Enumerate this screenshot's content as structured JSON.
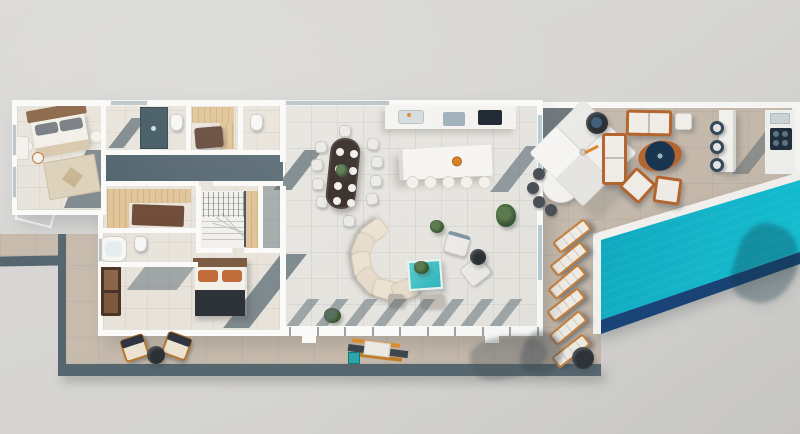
{
  "scene": {
    "type": "3d-floor-plan-render",
    "description": "Top-down 3D rendered villa floor plan with bedrooms, bathrooms, open-plan kitchen-dining-living space, wrap-around stone terrace, outdoor lounge with square parasol, outdoor kitchen and bar, six sun loungers and a turquoise swimming pool"
  },
  "palette": {
    "background": "#d8d7d5",
    "wall": "#fafaf8",
    "floor_left_wing": "#e8e3da",
    "floor_open_plan": "#e6e4df",
    "terrace": "#c7bbad",
    "slate": "#55666f",
    "pool_water": "#10b9cf",
    "pool_water_deep": "#0aa6be",
    "pool_wall": "#123e72",
    "wood_light": "#e0c396",
    "wood_mid": "#b5652f",
    "wood_dark": "#6b4a33",
    "orange_accent": "#d08035",
    "cream_cushion": "#ece2d1",
    "white_furniture": "#f3f1ec",
    "dark_table": "#2b3035",
    "teal_table": "#3bbfc4",
    "plant_green": "#3c5a36",
    "bed_blanket": "#2c3237",
    "glass_blue": "#b7ccd6",
    "lounger_frame": "#c97e35",
    "lounger_cushion": "#f2efe8"
  },
  "furniture": {
    "sun_loungers": {
      "count": 6,
      "w": 40,
      "h": 14,
      "items": [
        {
          "x": 552,
          "y": 229,
          "r": -38
        },
        {
          "x": 549,
          "y": 252,
          "r": -39
        },
        {
          "x": 547,
          "y": 275,
          "r": -40
        },
        {
          "x": 546,
          "y": 298,
          "r": -38
        },
        {
          "x": 548,
          "y": 321,
          "r": -40
        },
        {
          "x": 551,
          "y": 344,
          "r": -38
        }
      ],
      "side_table": {
        "x": 572,
        "y": 347,
        "d": 22
      }
    },
    "dining": {
      "table": {
        "x": 328,
        "y": 138,
        "w": 30,
        "h": 71,
        "r": 6,
        "color": "#362c27"
      },
      "plates": [
        [
          336,
          148
        ],
        [
          350,
          150
        ],
        [
          335,
          165
        ],
        [
          349,
          167
        ],
        [
          334,
          182
        ],
        [
          348,
          184
        ],
        [
          333,
          197
        ],
        [
          347,
          199
        ]
      ],
      "chairs": [
        [
          315,
          141,
          -8
        ],
        [
          311,
          159,
          -4
        ],
        [
          312,
          178,
          4
        ],
        [
          316,
          196,
          10
        ],
        [
          367,
          138,
          8
        ],
        [
          371,
          156,
          2
        ],
        [
          370,
          175,
          -4
        ],
        [
          366,
          193,
          -10
        ],
        [
          339,
          125,
          0
        ],
        [
          343,
          215,
          3
        ]
      ]
    },
    "island_stools": {
      "y": 176,
      "xs": [
        406,
        424,
        442,
        460,
        478
      ]
    },
    "sofa": {
      "cx": 394,
      "cy": 258,
      "r": 33,
      "cw": 26,
      "ch": 19,
      "angles": [
        127,
        159,
        191,
        223,
        255,
        289
      ]
    },
    "bar_stools": [
      [
        710,
        121
      ],
      [
        710,
        140
      ],
      [
        710,
        158
      ]
    ],
    "umbrella_chairs": [
      [
        533,
        168
      ],
      [
        527,
        182
      ],
      [
        533,
        196
      ],
      [
        545,
        204
      ]
    ],
    "glass_wall": {
      "tick_count": 10,
      "start_x": 289,
      "spacing": 27.5,
      "tick_y": 327
    },
    "mullion_shadows": {
      "count": 8,
      "start_x": 297,
      "spacing": 29,
      "y": 299,
      "w": 12,
      "h": 27
    },
    "stair_treads": {
      "count": 8,
      "x": 202,
      "w": 42,
      "start_y": 197,
      "step": 6
    }
  }
}
